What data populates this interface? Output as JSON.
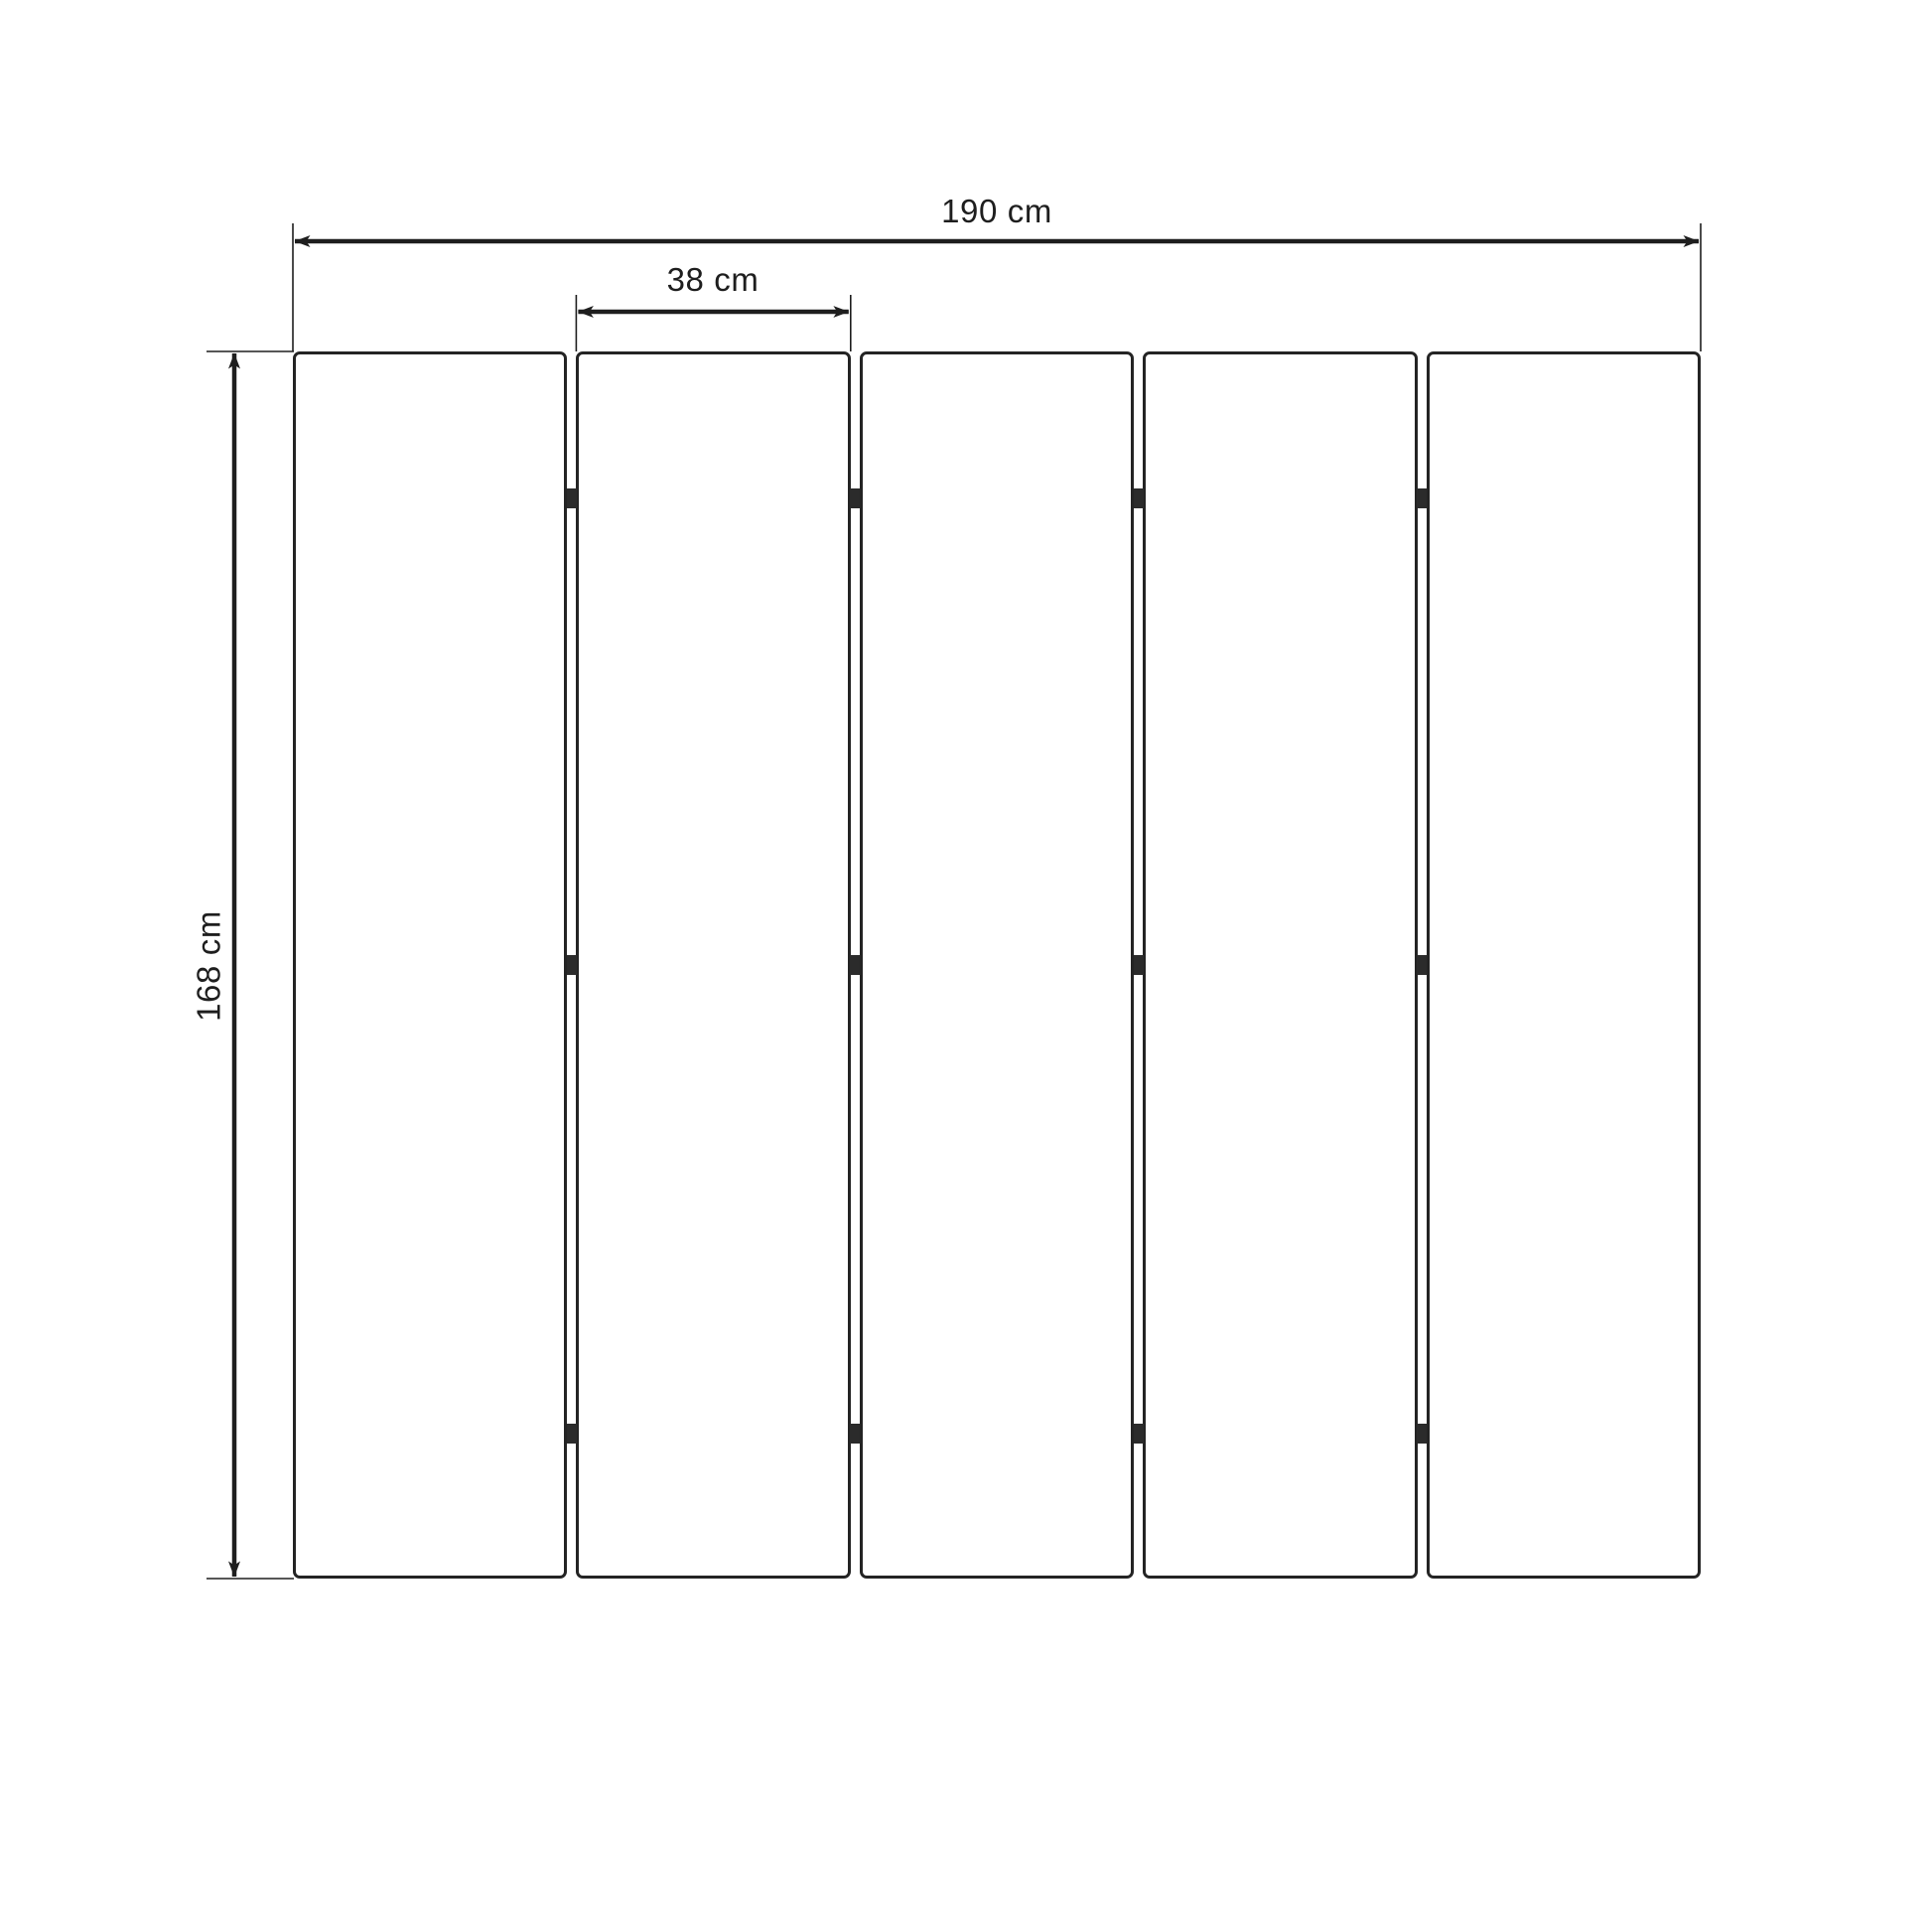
{
  "diagram": {
    "title": "five-panel folding screen dimension drawing",
    "total_width_label": "190 cm",
    "panel_width_label": "38 cm",
    "height_label": "168 cm",
    "panel_count": 5,
    "hinges_per_gap": 3,
    "hinge_fractions": [
      0.12,
      0.5,
      0.882
    ],
    "colors": {
      "line": "#1e1e1e",
      "panel_border": "#242424",
      "hinge": "#2b2b2b",
      "background": "#ffffff",
      "text": "#1e1e1e"
    }
  }
}
